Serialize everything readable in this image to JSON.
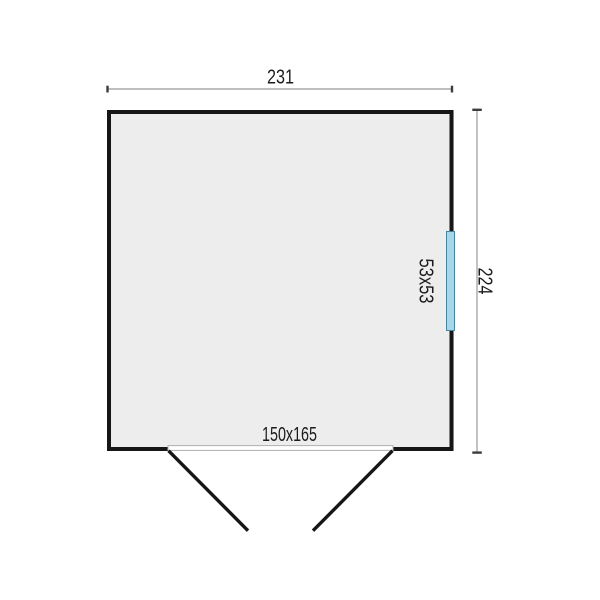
{
  "plan": {
    "top_dimension": "231",
    "right_dimension": "224",
    "window_label": "53x53",
    "door_label": "150x165"
  },
  "colors": {
    "background": "#ffffff",
    "wall": "#161616",
    "floor_fill": "#ededed",
    "dimension_line": "#a8a8a8",
    "dimension_tick": "#3d3d3d",
    "label_text": "#1c1c1c",
    "window_fill": "#a5d6e9",
    "window_border": "#47849e",
    "threshold_border": "#b0b0b0"
  }
}
